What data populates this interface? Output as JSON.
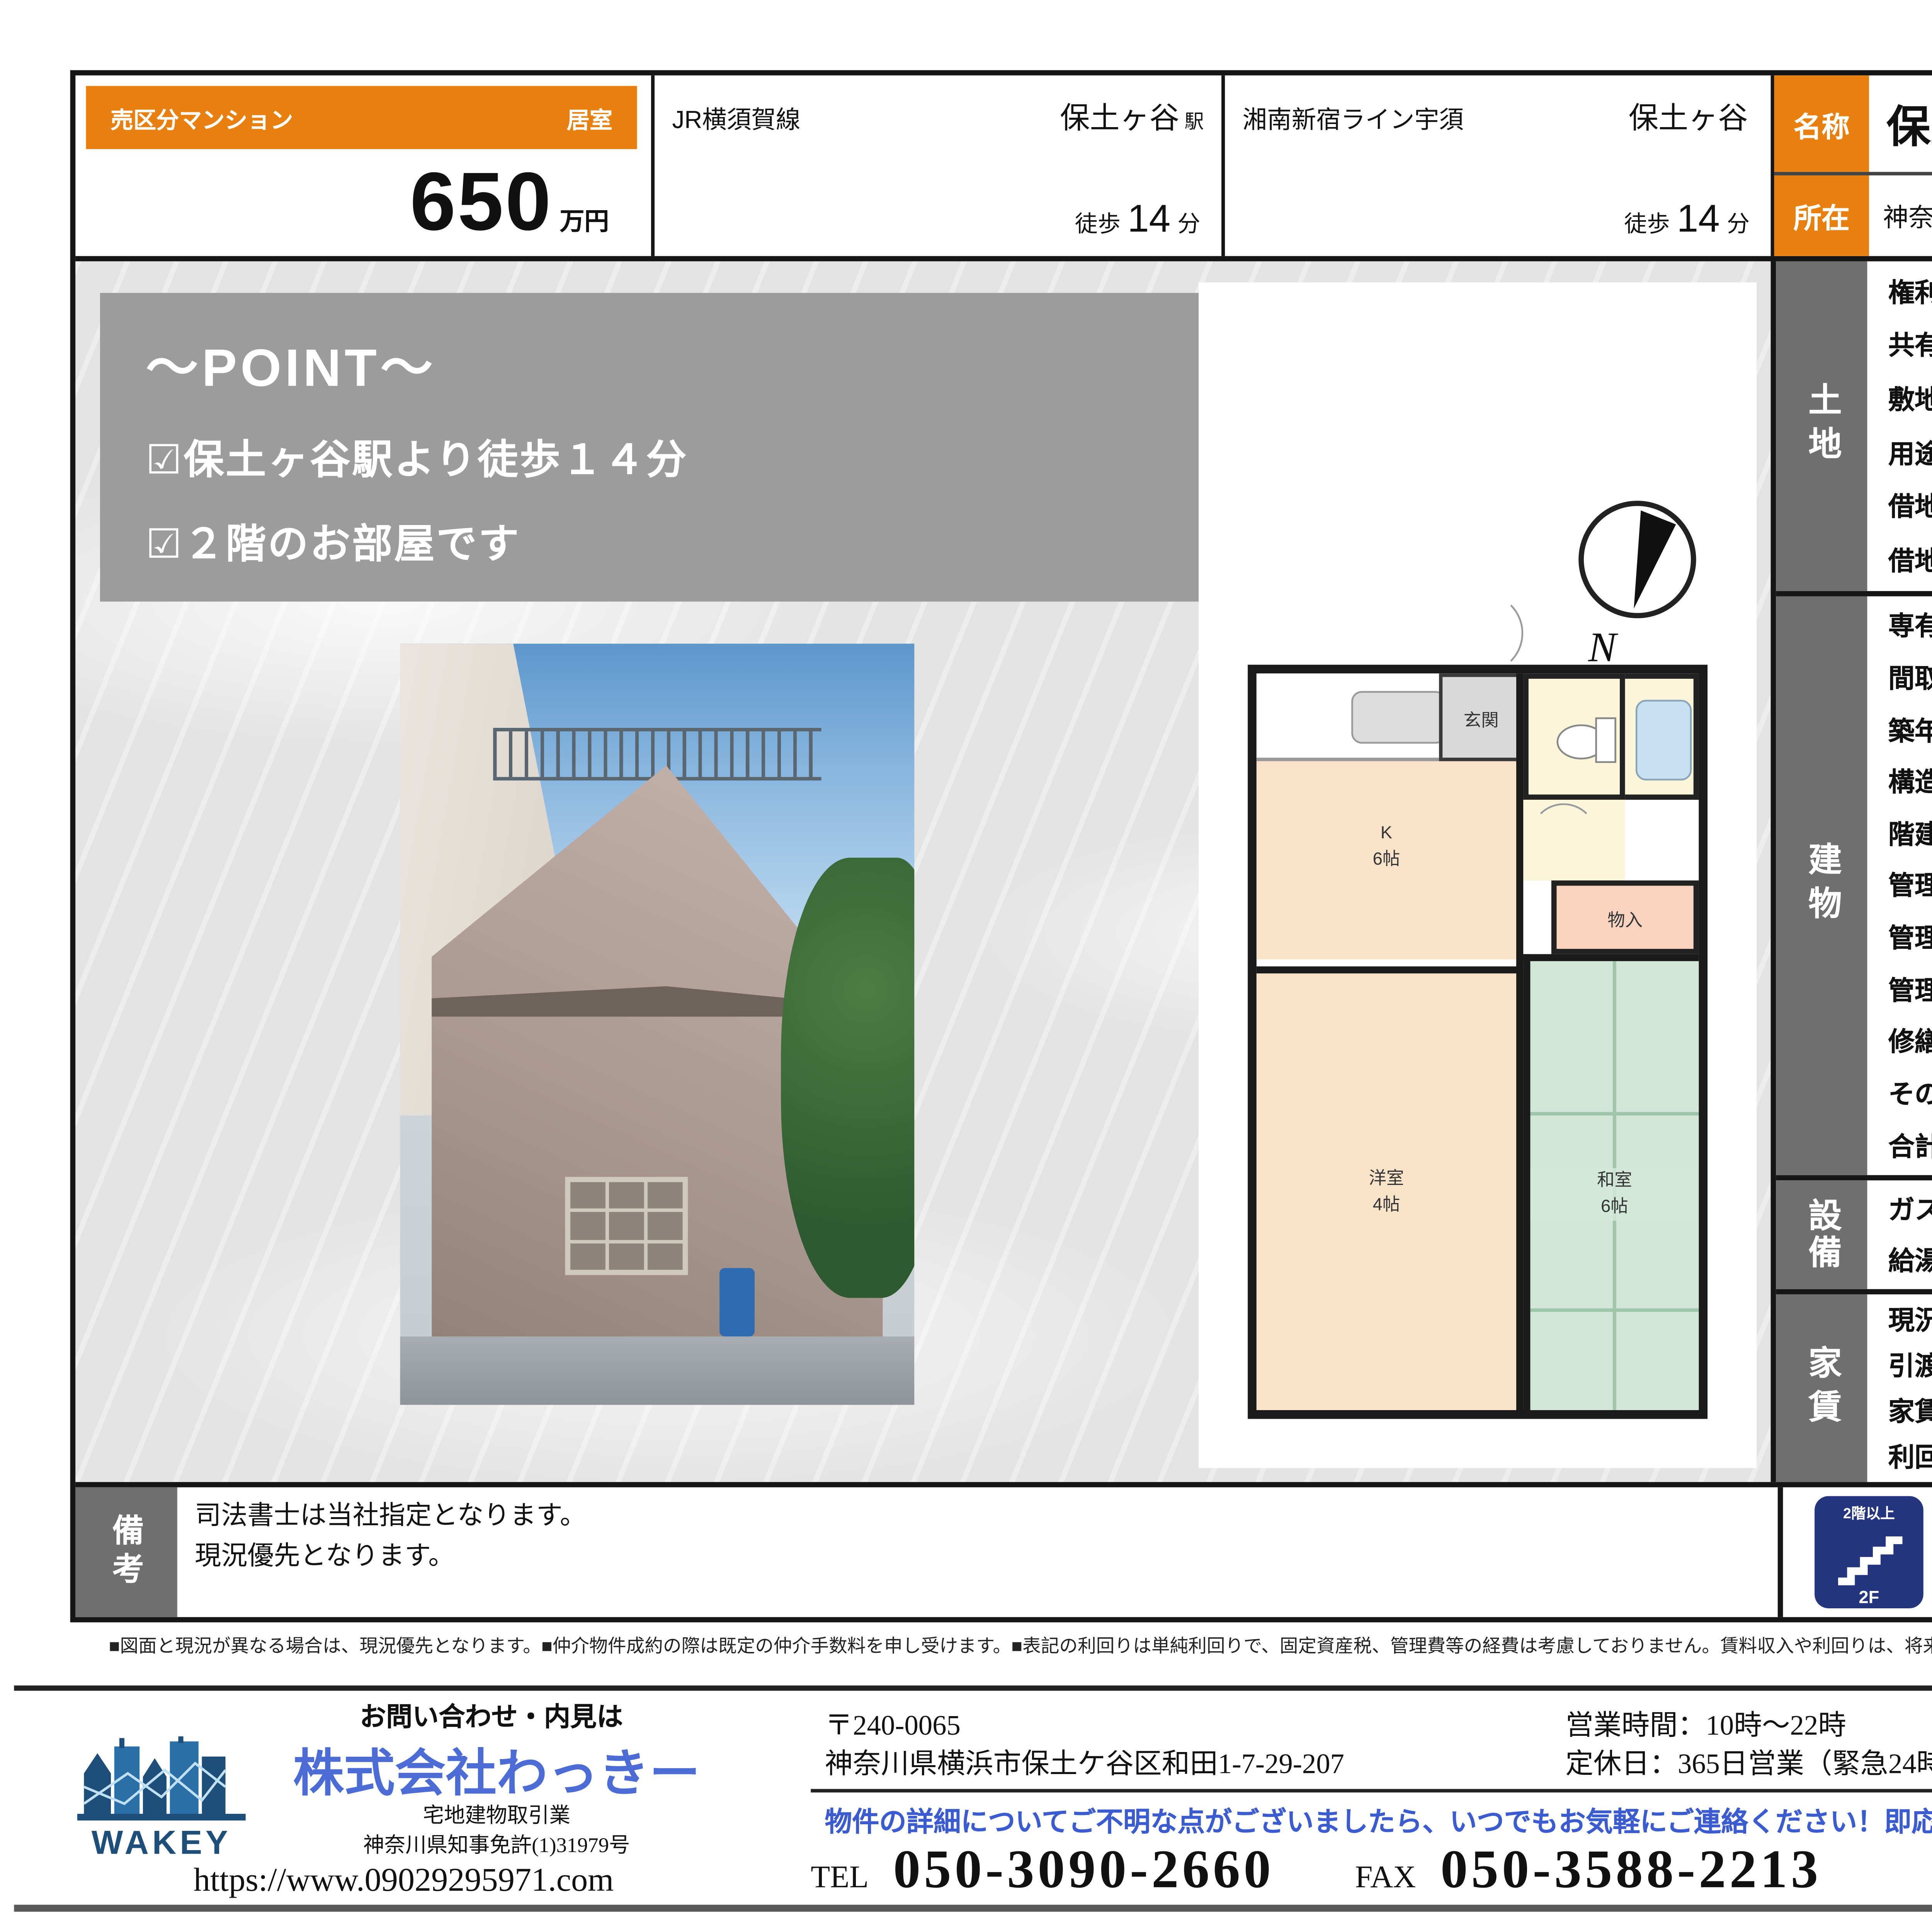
{
  "colors": {
    "accent_orange": "#e8800f",
    "section_gray": "#6f6f6f",
    "point_gray": "#9c9c9c",
    "badge_blue": "#24357f",
    "brand_blue": "#4b6bd5",
    "message_blue": "#3b5bd0",
    "consult_bg": "#d7ecf2"
  },
  "header": {
    "category": "売区分マンション",
    "room_type": "居室",
    "price": "650",
    "price_unit": "万円",
    "access": [
      {
        "line": "JR横須賀線",
        "station": "保土ヶ谷",
        "station_suffix": "駅",
        "walk_label": "徒歩",
        "walk_min": "14",
        "walk_unit": "分"
      },
      {
        "line": "湘南新宿ライン宇須",
        "station": "保土ヶ谷",
        "station_suffix": "",
        "walk_label": "徒歩",
        "walk_min": "14",
        "walk_unit": "分"
      }
    ],
    "name_label": "名称",
    "name": "保土ケ谷ハイツ",
    "address_label": "所在",
    "address": "神奈川県横浜市保土ケ谷区瀬戸ケ谷町153"
  },
  "point": {
    "title": "～POINT～",
    "items": [
      "☑保土ヶ谷駅より徒歩１４分",
      "☑２階のお部屋です"
    ]
  },
  "floor_plan": {
    "entrance": "玄関",
    "kitchen": "K",
    "kitchen_size": "6帖",
    "closet": "物入",
    "western_room": "洋室",
    "western_size": "4帖",
    "japanese_room": "和室",
    "japanese_size": "6帖",
    "compass_n": "N"
  },
  "land": {
    "section": "土地",
    "rows": [
      {
        "label": "権利",
        "value": "所有権"
      },
      {
        "label": "共有持分",
        "value": ""
      },
      {
        "label": "敷地面積",
        "value": "㎡"
      },
      {
        "label": "用途地域",
        "value": "第1種住居地域"
      },
      {
        "label": "借地料",
        "value": "該当なし"
      },
      {
        "label": "借地期間",
        "value": "該当なし"
      }
    ]
  },
  "building": {
    "section": "建物",
    "exclusive": {
      "label": "専有部分",
      "registry_label": "登記簿",
      "registry_area": "32.17㎡",
      "balcony_label": "バルコニー",
      "balcony_area": "0.00",
      "balcony_unit": "㎡"
    },
    "layout": {
      "label": "間取り",
      "value": "2DK",
      "direction_label": "方位",
      "direction": "東南",
      "units_label": "総戸数",
      "units": "8戸"
    },
    "built": {
      "label": "築年",
      "year": "1977",
      "year_unit": "年",
      "month": "02月（昭和52年02月）"
    },
    "structure": {
      "label": "構造",
      "value": "鉄骨造"
    },
    "floors": {
      "label": "階建",
      "value": "3階建て",
      "part": "2階部分"
    },
    "mgmt_company": {
      "label": "管理会社",
      "value": ""
    },
    "mgmt_type": {
      "label": "管理形態",
      "value": "自主管理"
    },
    "mgmt_fee": {
      "label": "管理費",
      "monthly": "月額",
      "value": "0",
      "unit": "円"
    },
    "repair_fund": {
      "label": "修繕積立金",
      "monthly": "月額",
      "value": "6,000",
      "unit": "円"
    },
    "other_fee": {
      "label": "その他費用",
      "monthly": "月額",
      "value": "0",
      "unit": "円"
    },
    "total_fee": {
      "label": "合計",
      "monthly": "月額",
      "value": "6,000",
      "unit": "円"
    }
  },
  "facilities": {
    "section": "設備",
    "rows": [
      {
        "k1": "ガス",
        "v1": "都市ガス",
        "k2": "エレベーター",
        "v2": "なし"
      },
      {
        "k1": "給湯",
        "v1": "ガス給湯器",
        "k2": "敷地内駐車場",
        "v2": "無"
      }
    ]
  },
  "rent": {
    "section": "家賃",
    "genkyo": {
      "label": "現況",
      "value": "賃貸中"
    },
    "hikiwatashi": {
      "label": "引渡し日",
      "value": "相談"
    },
    "yachin": {
      "label": "家賃",
      "monthly": "月額",
      "value": "54,000円"
    },
    "rimawari": {
      "label": "利回り",
      "value": "9.96 %"
    }
  },
  "remarks": {
    "section": "備考",
    "lines": [
      "司法書士は当社指定となります。",
      "現況優先となります。"
    ]
  },
  "badges": [
    {
      "top": "2階以上",
      "bottom": "2F"
    },
    {
      "top": "バス・トイレ別"
    }
  ],
  "disclaimer": "■図面と現況が異なる場合は、現況優先となります。■仲介物件成約の際は既定の仲介手数料を申し受けます。■表記の利回りは単純利回りで、固定資産税、管理費等の経費は考慮しておりません。賃料収入や利回りは、将来にわたって確実に得られることを保証するものではありません。",
  "footer": {
    "inquiry_heading": "お問い合わせ・内見は",
    "logo_text": "WAKEY",
    "company": "株式会社わっきー",
    "license_type": "宅地建物取引業",
    "license_no": "神奈川県知事免許(1)31979号",
    "url": "https://www.09029295971.com",
    "postal": "〒240-0065",
    "office_address": "神奈川県横浜市保土ケ谷区和田1-7-29-207",
    "hours": "営業時間：10時～22時",
    "holidays": "定休日：365日営業（緊急24時間）",
    "message": "物件の詳細についてご不明な点がございましたら、いつでもお気軽にご連絡ください！即応します！",
    "tel_label": "TEL",
    "tel": "050-3090-2660",
    "fax_label": "FAX",
    "fax": "050-3588-2213",
    "consult_lines": [
      "お気軽に",
      "御相談",
      "ください！"
    ],
    "email": "info@09029295971.com"
  }
}
